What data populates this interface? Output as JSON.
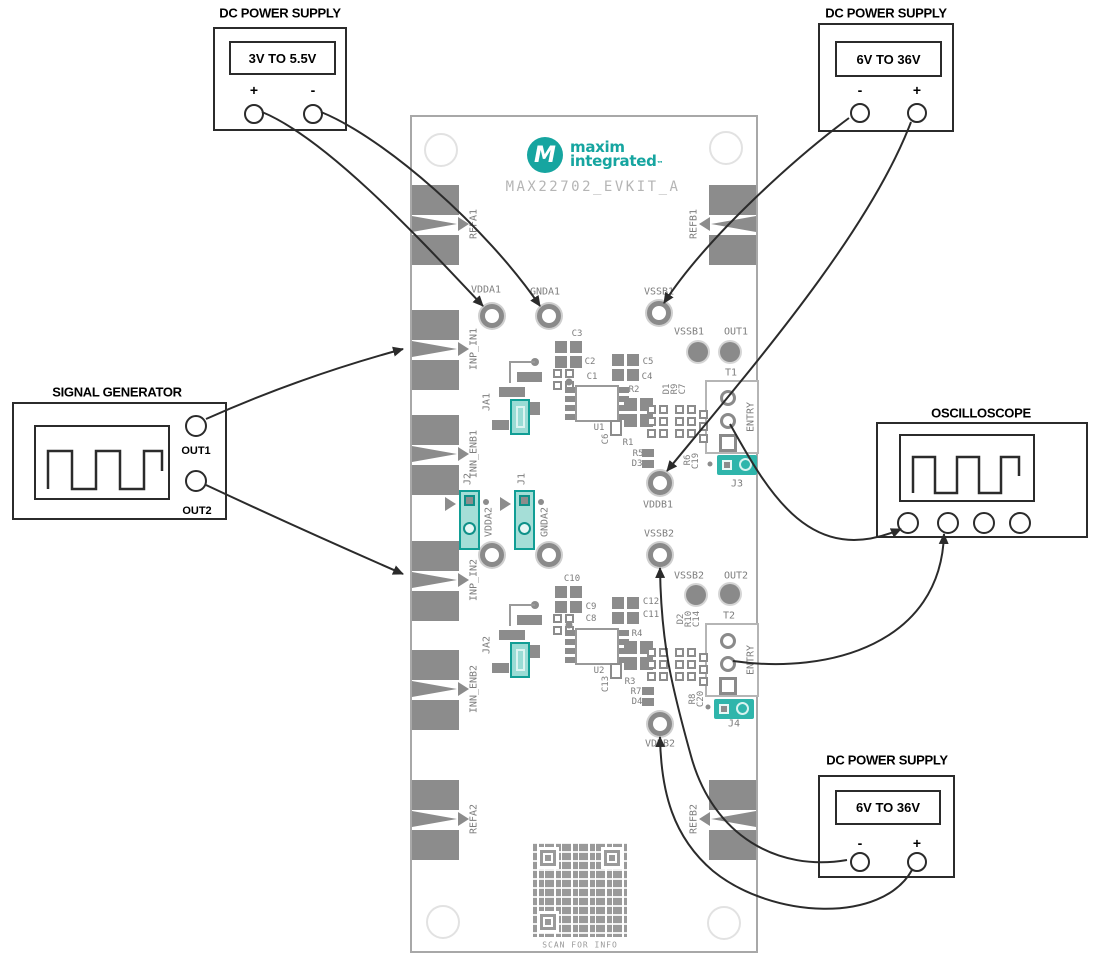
{
  "devices": {
    "psu_top_left": {
      "title": "DC POWER SUPPLY",
      "range": "3V TO 5.5V",
      "pos_label": "+",
      "neg_label": "-"
    },
    "psu_top_right": {
      "title": "DC POWER SUPPLY",
      "range": "6V TO 36V",
      "pos_label": "+",
      "neg_label": "-"
    },
    "psu_bottom_right": {
      "title": "DC POWER SUPPLY",
      "range": "6V TO 36V",
      "pos_label": "+",
      "neg_label": "-"
    },
    "signal_generator": {
      "title": "SIGNAL GENERATOR",
      "out1_label": "OUT1",
      "out2_label": "OUT2"
    },
    "oscilloscope": {
      "title": "OSCILLOSCOPE"
    }
  },
  "board": {
    "silkscreen_title": "MAX22702_EVKIT_A",
    "logo": {
      "mark": "M",
      "line1": "maxim",
      "line2": "integrated",
      "tm": "™"
    },
    "qr_caption": "SCAN FOR INFO",
    "edge_labels": {
      "refa1": "REFA1",
      "inp_in1": "INP_IN1",
      "inn_enb1": "INN_ENB1",
      "inp_in2": "INP_IN2",
      "inn_enb2": "INN_ENB2",
      "refa2": "REFA2",
      "refb1": "REFB1",
      "refb2": "REFB2"
    },
    "test_points": {
      "vdda1": "VDDA1",
      "gnda1": "GNDA1",
      "vssb1": "VSSB1",
      "vddb1": "VDDB1",
      "vdda2": "VDDA2",
      "gnda2": "GNDA2",
      "vssb2": "VSSB2",
      "vddb2": "VDDB2"
    },
    "vias": {
      "vssb1": "VSSB1",
      "out1": "OUT1",
      "vssb2": "VSSB2",
      "out2": "OUT2"
    },
    "connectors": {
      "t1": "T1",
      "t2": "T2",
      "entry_t1": "ENTRY",
      "entry_t2": "ENTRY",
      "j1": "J1",
      "j2": "J2",
      "j3": "J3",
      "j4": "J4",
      "ja1": "JA1",
      "ja2": "JA2"
    },
    "components": {
      "c1": "C1",
      "c2": "C2",
      "c3": "C3",
      "c4": "C4",
      "c5": "C5",
      "c6": "C6",
      "c7": "C7",
      "c8": "C8",
      "c9": "C9",
      "c10": "C10",
      "c11": "C11",
      "c12": "C12",
      "c13": "C13",
      "c14": "C14",
      "c19": "C19",
      "c20": "C20",
      "r1": "R1",
      "r2": "R2",
      "r3": "R3",
      "r4": "R4",
      "r5": "R5",
      "r6": "R6",
      "r7": "R7",
      "r8": "R8",
      "r9": "R9",
      "r10": "R10",
      "d1": "D1",
      "d2": "D2",
      "d3": "D3",
      "d4": "D4",
      "u1": "U1",
      "u2": "U2"
    }
  },
  "connections": [
    {
      "from": "DC supply 3V-5.5V (+)",
      "to": "VDDA1"
    },
    {
      "from": "DC supply 3V-5.5V (-)",
      "to": "GNDA1"
    },
    {
      "from": "DC supply 6V-36V top (-)",
      "to": "VSSB1"
    },
    {
      "from": "DC supply 6V-36V top (+)",
      "to": "VDDB1"
    },
    {
      "from": "Signal generator OUT1",
      "to": "INP_IN1"
    },
    {
      "from": "Signal generator OUT2",
      "to": "INP_IN2"
    },
    {
      "from": "T1 ENTRY",
      "to": "Oscilloscope input 1"
    },
    {
      "from": "T2 ENTRY",
      "to": "Oscilloscope input 2"
    },
    {
      "from": "DC supply 6V-36V bottom (-)",
      "to": "VSSB2"
    },
    {
      "from": "DC supply 6V-36V bottom (+)",
      "to": "VDDB2"
    }
  ],
  "colors": {
    "teal": "#16A5A0",
    "pad_gray": "#8C8C8C",
    "silkscreen_gray": "#7D7D7D",
    "wire": "#2B2B2B",
    "board_title_gray": "#B5B5B5"
  }
}
